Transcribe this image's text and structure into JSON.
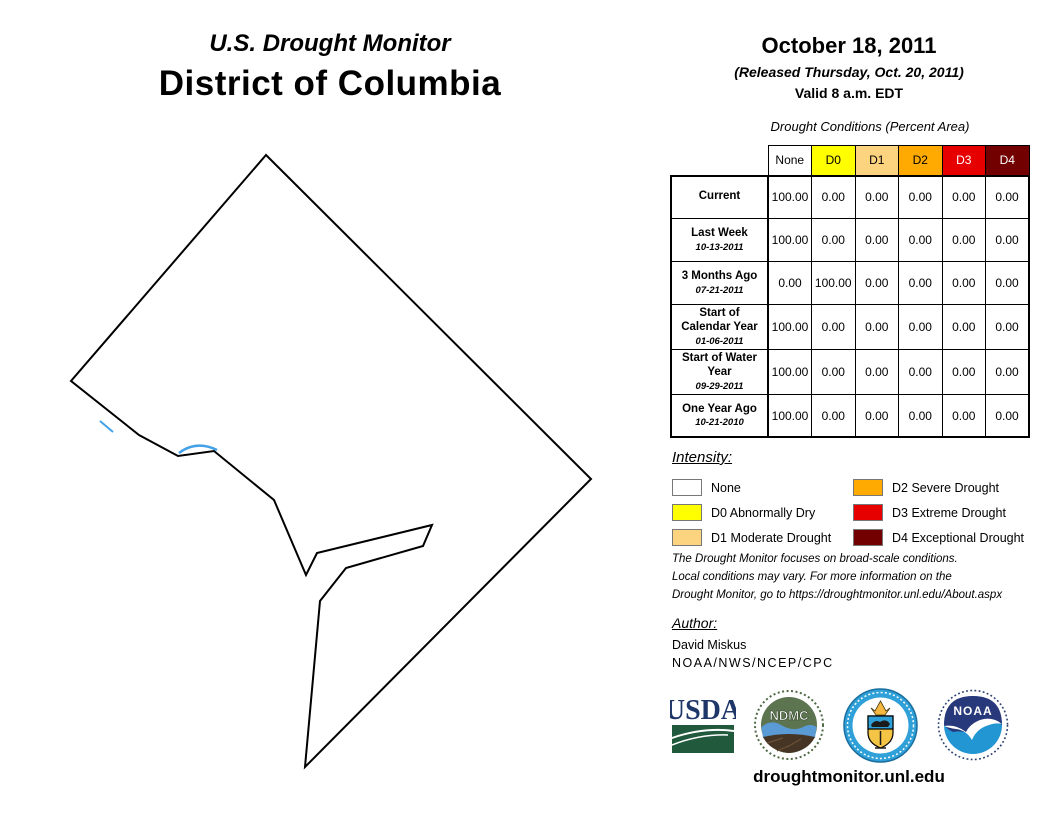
{
  "header": {
    "title_small": "U.S. Drought Monitor",
    "title_large": "District of Columbia",
    "date": "October 18, 2011",
    "released": "(Released Thursday, Oct. 20, 2011)",
    "valid": "Valid 8 a.m. EDT"
  },
  "table": {
    "caption": "Drought Conditions (Percent Area)",
    "columns": [
      {
        "label": "None",
        "color": "#FFFFFF",
        "text_color": "#000000"
      },
      {
        "label": "D0",
        "color": "#FFFF00",
        "text_color": "#000000"
      },
      {
        "label": "D1",
        "color": "#FCD37F",
        "text_color": "#000000"
      },
      {
        "label": "D2",
        "color": "#FFAA00",
        "text_color": "#000000"
      },
      {
        "label": "D3",
        "color": "#E60000",
        "text_color": "#FFFFFF"
      },
      {
        "label": "D4",
        "color": "#730000",
        "text_color": "#FFFFFF"
      }
    ],
    "rows": [
      {
        "label": "Current",
        "date": "",
        "values": [
          "100.00",
          "0.00",
          "0.00",
          "0.00",
          "0.00",
          "0.00"
        ]
      },
      {
        "label": "Last Week",
        "date": "10-13-2011",
        "values": [
          "100.00",
          "0.00",
          "0.00",
          "0.00",
          "0.00",
          "0.00"
        ]
      },
      {
        "label": "3 Months Ago",
        "date": "07-21-2011",
        "values": [
          "0.00",
          "100.00",
          "0.00",
          "0.00",
          "0.00",
          "0.00"
        ]
      },
      {
        "label": "Start of Calendar Year",
        "date": "01-06-2011",
        "values": [
          "100.00",
          "0.00",
          "0.00",
          "0.00",
          "0.00",
          "0.00"
        ]
      },
      {
        "label": "Start of Water Year",
        "date": "09-29-2011",
        "values": [
          "100.00",
          "0.00",
          "0.00",
          "0.00",
          "0.00",
          "0.00"
        ]
      },
      {
        "label": "One Year Ago",
        "date": "10-21-2010",
        "values": [
          "100.00",
          "0.00",
          "0.00",
          "0.00",
          "0.00",
          "0.00"
        ]
      }
    ]
  },
  "legend": {
    "heading": "Intensity:",
    "items": [
      {
        "label": "None",
        "color": "#FFFFFF"
      },
      {
        "label": "D0 Abnormally Dry",
        "color": "#FFFF00"
      },
      {
        "label": "D1 Moderate Drought",
        "color": "#FCD37F"
      },
      {
        "label": "D2 Severe Drought",
        "color": "#FFAA00"
      },
      {
        "label": "D3 Extreme Drought",
        "color": "#E60000"
      },
      {
        "label": "D4 Exceptional Drought",
        "color": "#730000"
      }
    ]
  },
  "notes": "The Drought Monitor focuses on broad-scale conditions.\nLocal conditions may vary. For more information on the\nDrought Monitor, go to https://droughtmonitor.unl.edu/About.aspx",
  "author": {
    "heading": "Author:",
    "name": "David Miskus",
    "org": "NOAA/NWS/NCEP/CPC"
  },
  "logos": {
    "usda": "USDA",
    "ndmc": "NDMC",
    "noaa": "NOAA"
  },
  "footer": {
    "url": "droughtmonitor.unl.edu"
  }
}
